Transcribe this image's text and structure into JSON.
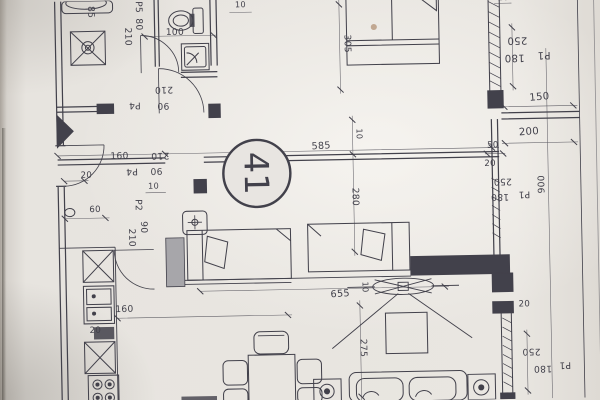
{
  "unit_badge": {
    "number": "41"
  },
  "colors": {
    "paper": "#e8e5e1",
    "ink": "#42414b",
    "furniture_gray": "#a7a6aa",
    "stain": "#96653d"
  },
  "labels": [
    {
      "text": "85",
      "x": 95,
      "y": 11,
      "rot": 90
    },
    {
      "text": "P5",
      "x": 142,
      "y": 7,
      "rot": 90
    },
    {
      "text": "80",
      "x": 142,
      "y": 24,
      "rot": 90
    },
    {
      "text": "210",
      "x": 131,
      "y": 36,
      "rot": 90
    },
    {
      "text": "10",
      "x": 245,
      "y": 9,
      "rot": 0,
      "size": 8
    },
    {
      "text": "100",
      "x": 180,
      "y": 35,
      "rot": 0
    },
    {
      "text": "305",
      "x": 347,
      "y": 47,
      "rot": 90
    },
    {
      "text": "20",
      "x": 504,
      "y": 7,
      "rot": 0,
      "size": 8
    },
    {
      "text": "250",
      "x": 517,
      "y": 44,
      "rot": 180,
      "size": 10
    },
    {
      "text": "180",
      "x": 514,
      "y": 61,
      "rot": 180,
      "size": 10
    },
    {
      "text": "P1",
      "x": 543,
      "y": 59,
      "rot": 180,
      "size": 10
    },
    {
      "text": "150",
      "x": 538,
      "y": 106,
      "rot": -4,
      "size": 10
    },
    {
      "text": "200",
      "x": 527,
      "y": 140,
      "rot": -3,
      "size": 10
    },
    {
      "text": "50",
      "x": 491,
      "y": 152,
      "rot": 0,
      "size": 8.5
    },
    {
      "text": "20",
      "x": 488,
      "y": 170,
      "rot": 0,
      "size": 8.5
    },
    {
      "text": "250",
      "x": 500,
      "y": 183,
      "rot": 180
    },
    {
      "text": "180",
      "x": 497,
      "y": 198,
      "rot": 180
    },
    {
      "text": "P1",
      "x": 521,
      "y": 196,
      "rot": 180
    },
    {
      "text": "900",
      "x": 541,
      "y": 189,
      "rot": -90
    },
    {
      "text": "585",
      "x": 322,
      "y": 150,
      "rot": -2,
      "size": 9.5
    },
    {
      "text": "10",
      "x": 357,
      "y": 136,
      "rot": 90,
      "size": 8
    },
    {
      "text": "280",
      "x": 352,
      "y": 198,
      "rot": 90
    },
    {
      "text": "210",
      "x": 168,
      "y": 86,
      "rot": 180
    },
    {
      "text": "90",
      "x": 167,
      "y": 102,
      "rot": 180
    },
    {
      "text": "P4",
      "x": 139,
      "y": 101,
      "rot": 180
    },
    {
      "text": "160",
      "x": 123,
      "y": 156,
      "rot": 0
    },
    {
      "text": "210",
      "x": 163,
      "y": 151,
      "rot": 180
    },
    {
      "text": "90",
      "x": 159,
      "y": 166,
      "rot": 180
    },
    {
      "text": "P4",
      "x": 135,
      "y": 166,
      "rot": 180
    },
    {
      "text": "10",
      "x": 156,
      "y": 186,
      "rot": 0,
      "size": 8
    },
    {
      "text": "P2",
      "x": 138,
      "y": 202,
      "rot": 90
    },
    {
      "text": "90",
      "x": 143,
      "y": 224,
      "rot": 90
    },
    {
      "text": "210",
      "x": 131,
      "y": 234,
      "rot": 90
    },
    {
      "text": "20",
      "x": 90,
      "y": 174,
      "rot": 0,
      "size": 8.5
    },
    {
      "text": "60",
      "x": 98,
      "y": 208,
      "rot": 0,
      "size": 8.5
    },
    {
      "text": "160",
      "x": 125,
      "y": 307,
      "rot": 0
    },
    {
      "text": "20",
      "x": 96,
      "y": 327,
      "rot": 0,
      "size": 8.5
    },
    {
      "text": "655",
      "x": 338,
      "y": 296,
      "rot": -3,
      "size": 9.5
    },
    {
      "text": "10",
      "x": 360,
      "y": 287,
      "rot": 90,
      "size": 8
    },
    {
      "text": "20",
      "x": 519,
      "y": 309,
      "rot": 0,
      "size": 8.5
    },
    {
      "text": "275",
      "x": 357,
      "y": 347,
      "rot": 90
    },
    {
      "text": "250",
      "x": 525,
      "y": 351,
      "rot": 180
    },
    {
      "text": "180",
      "x": 536,
      "y": 368,
      "rot": 180
    },
    {
      "text": "P1",
      "x": 558,
      "y": 365,
      "rot": 180
    }
  ]
}
